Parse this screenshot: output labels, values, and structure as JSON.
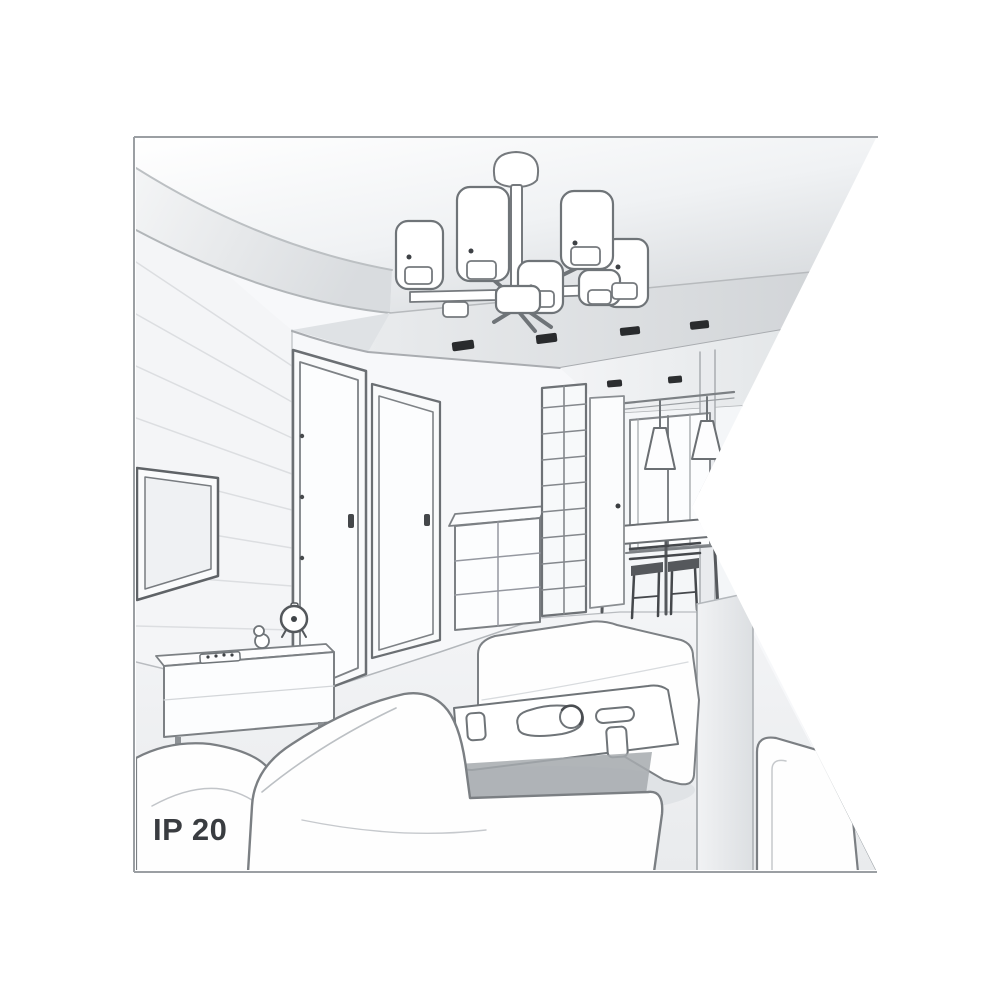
{
  "illustration": {
    "ip_rating_label": "IP 20",
    "type": "interior-living-room-line-drawing",
    "colors": {
      "background": "#ffffff",
      "border": "#9b9fa3",
      "line": "#6f7478",
      "line_dark": "#3e4145",
      "ceiling_shade": "#d9dcdf",
      "wall": "#f6f7f9",
      "floor": "#eceef0",
      "spotlight": "#2a2c2e"
    },
    "elements": [
      "ceiling-chandelier",
      "recessed-ceiling-panel",
      "ceiling-spotlights",
      "cove-ceiling-curves",
      "paneled-tv-wall",
      "wall-tv",
      "tv-stand",
      "alarm-clock",
      "decor-figurine",
      "remote-control",
      "interior-door-left",
      "interior-door-middle",
      "chest-of-drawers",
      "shelving-unit",
      "hallway-door",
      "dining-window",
      "pendant-lamps",
      "dining-table",
      "dining-chairs",
      "right-wall-column",
      "ottoman-bench",
      "coffee-table",
      "serving-plate",
      "cups",
      "sofa-left",
      "sofa-main",
      "armchair-right",
      "floor"
    ]
  }
}
